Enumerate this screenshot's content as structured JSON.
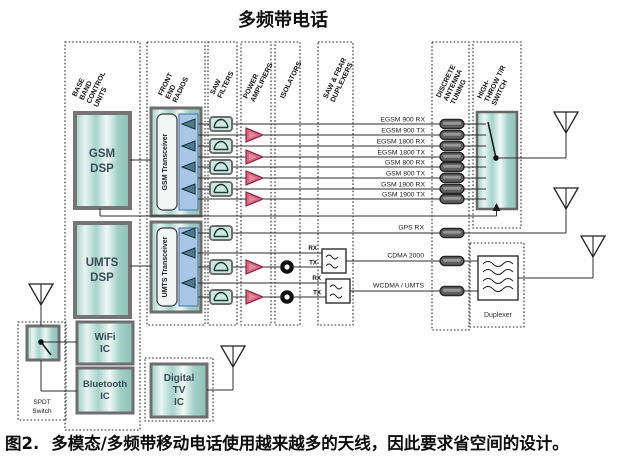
{
  "title": "多频带电话",
  "caption": {
    "figure_label": "图2.",
    "text": "多模态/多频带移动电话使用越来越多的天线，因此要求省空间的设计。"
  },
  "column_headers": {
    "baseband": {
      "l1": "BASE",
      "l2": "BAND",
      "l3": "CONTROL",
      "l4": "UNITS"
    },
    "front_end": {
      "l1": "FRONT",
      "l2": "END",
      "l3": "RADIOS"
    },
    "saw_filters": {
      "l1": "SAW",
      "l2": "FILTERS"
    },
    "power_amplifiers": {
      "l1": "POWER",
      "l2": "AMPLIFIERS"
    },
    "isolators": {
      "l1": "ISOLATORS"
    },
    "duplexers": {
      "l1": "SAW & FBAR",
      "l2": "DUPLEXERS"
    },
    "antenna_tuning": {
      "l1": "DISCRETE",
      "l2": "ANTENNA",
      "l3": "TUNING"
    },
    "tr_switch": {
      "l1": "HIGH-",
      "l2": "THROW T/R",
      "l3": "SWITCH"
    }
  },
  "blocks": {
    "gsm_dsp": {
      "l1": "GSM",
      "l2": "DSP"
    },
    "umts_dsp": {
      "l1": "UMTS",
      "l2": "DSP"
    },
    "wifi_ic": {
      "l1": "WiFi",
      "l2": "IC"
    },
    "bluetooth_ic": {
      "l1": "Bluetooth",
      "l2": "IC"
    },
    "digital_tv_ic": {
      "l1": "Digital",
      "l2": "TV",
      "l3": "IC"
    },
    "gsm_transceiver": "GSM Transceiver",
    "umts_transceiver": "UMTS Transceiver",
    "spdt_switch": {
      "l1": "SPDT",
      "l2": "Switch"
    },
    "duplexer_label": "Duplexer"
  },
  "signals": {
    "gsm_lines": [
      "EGSM 900 RX",
      "EGSM 900 TX",
      "EGSM 1800 RX",
      "EGSM 1800 TX",
      "GSM 800 RX",
      "GSM 800 TX",
      "GSM 1900 RX",
      "GSM 1900 TX"
    ],
    "gps": "GPS RX",
    "cdma": "CDMA 2000",
    "wcdma": "WCDMA / UMTS",
    "rx": "RX",
    "tx": "TX"
  },
  "colors": {
    "block_teal": "#aed5cd",
    "strip_blue": "#a9c6e6",
    "pa_pink": "#d56880",
    "line_dark": "#2e2e2e"
  }
}
